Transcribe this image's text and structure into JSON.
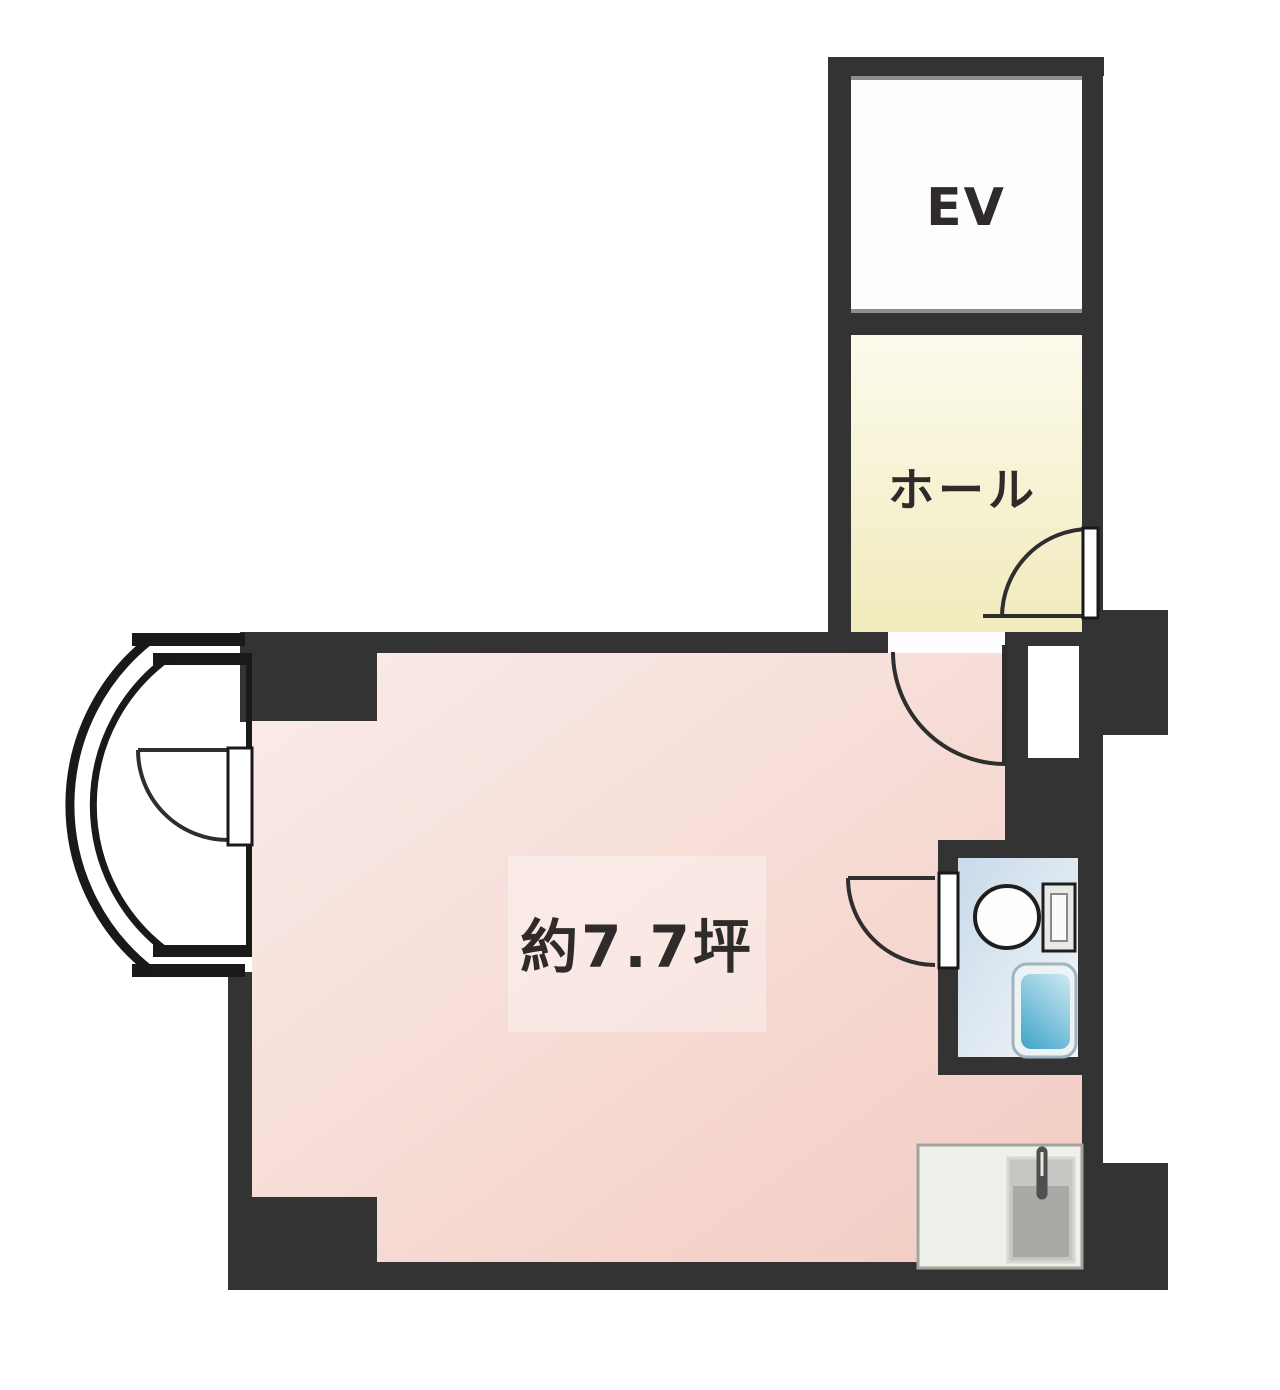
{
  "labels": {
    "elevator": "EV",
    "hall": "ホール",
    "main_room_area": "約7.7坪"
  },
  "colors": {
    "background": "#ffffff",
    "wall": "#333333",
    "line": "#191919",
    "door_arc": "#2e2e2e",
    "ev_fill": "#fdfdfd",
    "ev_edge": "#8e8e8e",
    "hall_top": "#fcfaec",
    "hall_bottom": "#f1ebbc",
    "room_light": "#faece9",
    "room_dark": "#f3cbc2",
    "label_overlay": "rgba(255,255,255,0.34)",
    "toilet_top": "#c9daea",
    "toilet_bottom": "#f2f6f9",
    "fixture_outline": "#1e1e1e",
    "basin_light": "#c3e4ef",
    "basin_dark": "#49a8cc",
    "counter_fill": "#eef0ea",
    "counter_edge": "#a3a39d",
    "sink_outer": "#c6c6c2",
    "sink_inner": "#a9a9a5",
    "faucet": "#4f4f4f",
    "opening_fill": "#fefefe",
    "text": "#2f2b2a"
  }
}
